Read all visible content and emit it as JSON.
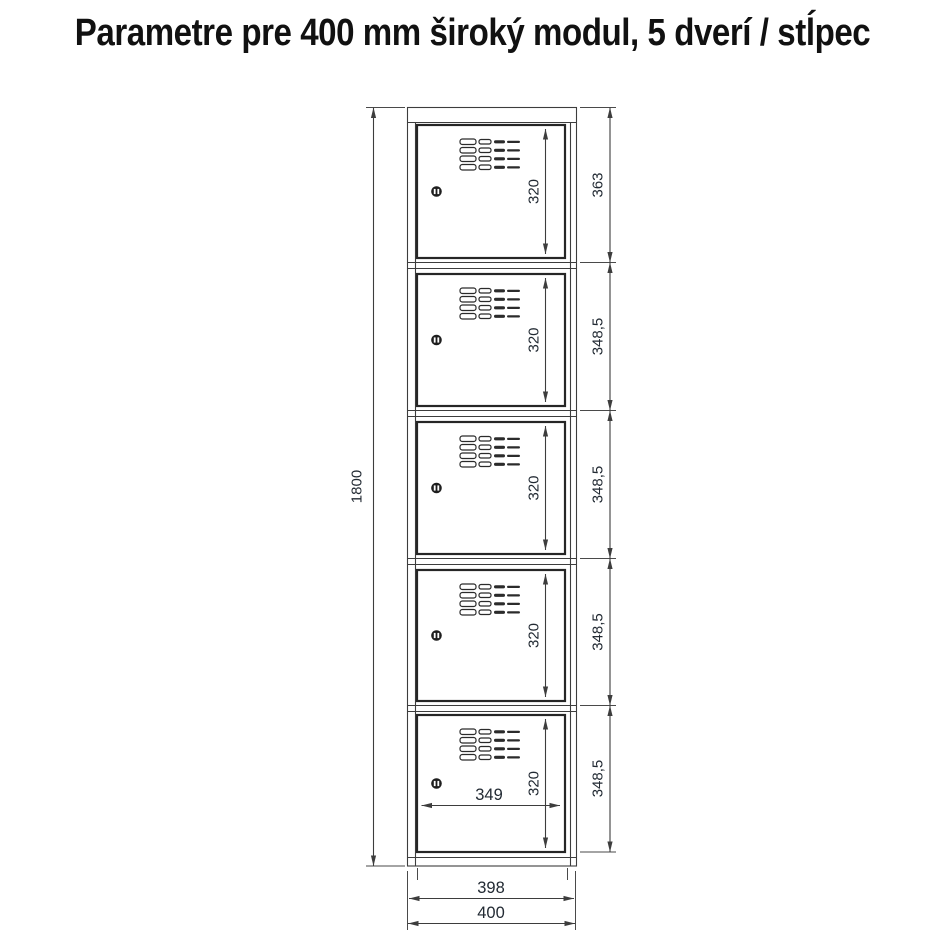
{
  "title": "Parametre pre 400 mm široký modul, 5 dverí / stĺpec",
  "drawing": {
    "overall_height": "1800",
    "overall_width": "400",
    "body_width": "398",
    "door_clear_width": "349",
    "bays": [
      {
        "pitch": "363",
        "door_height": "320"
      },
      {
        "pitch": "348,5",
        "door_height": "320"
      },
      {
        "pitch": "348,5",
        "door_height": "320"
      },
      {
        "pitch": "348,5",
        "door_height": "320"
      },
      {
        "pitch": "348,5",
        "door_height": "320"
      }
    ],
    "colors": {
      "line": "#3d3d3d",
      "door_border": "#262626",
      "dim_text": "#222a33"
    }
  }
}
